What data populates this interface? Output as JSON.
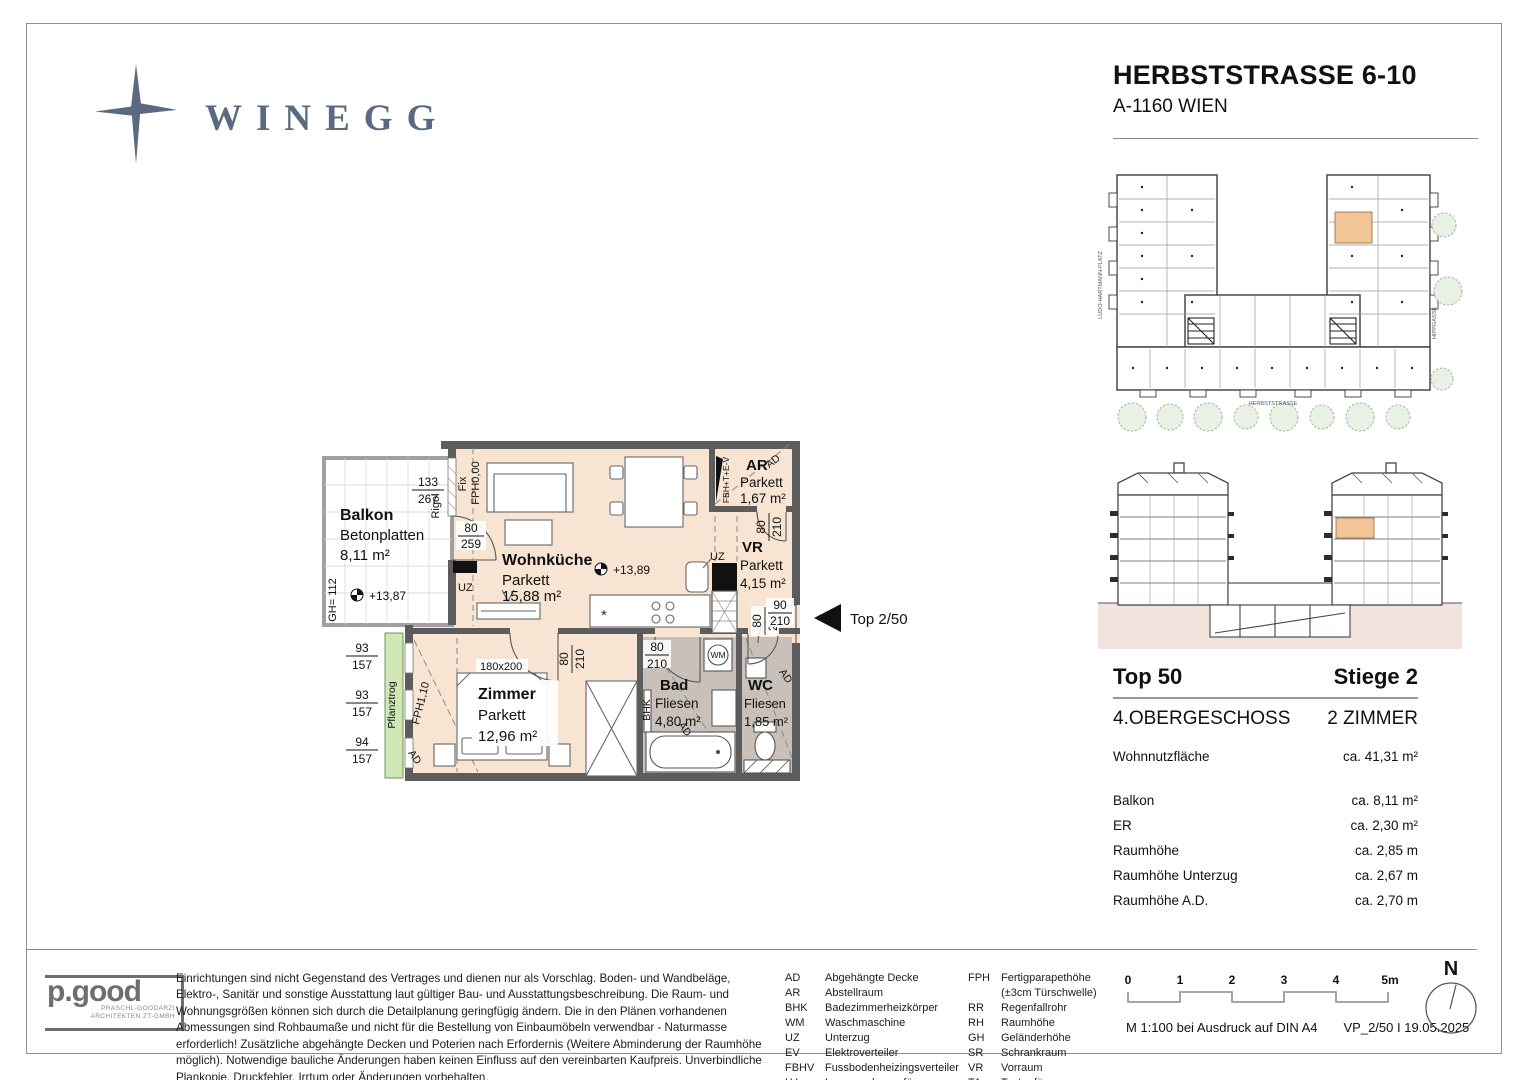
{
  "header": {
    "brand": "WINEGG",
    "project_title": "HERBSTSTRASSE 6-10",
    "project_location": "A-1160 WIEN"
  },
  "site_plan": {
    "street_left": "LUDO-HARTMANN-PLATZ",
    "street_bottom": "HERBSTSTRASSE",
    "street_right": "HIPPGASSE"
  },
  "floor_plan": {
    "entrance_label": "Top 2/50",
    "rooms": [
      {
        "name": "Balkon",
        "surface": "Betonplatten",
        "area": "8,11 m²"
      },
      {
        "name": "Wohnküche",
        "surface": "Parkett",
        "area": "15,88 m²"
      },
      {
        "name": "AR",
        "surface": "Parkett",
        "area": "1,67 m²"
      },
      {
        "name": "VR",
        "surface": "Parkett",
        "area": "4,15 m²"
      },
      {
        "name": "Zimmer",
        "surface": "Parkett",
        "area": "12,96 m²"
      },
      {
        "name": "Bad",
        "surface": "Fliesen",
        "area": "4,80 m²"
      },
      {
        "name": "WC",
        "surface": "Fliesen",
        "area": "1,85 m²"
      }
    ],
    "levels": {
      "balcony": "+13,87",
      "living": "+13,89"
    },
    "dims": {
      "balcony_door": {
        "num": "133",
        "den": "267"
      },
      "fix_window": {
        "num": "80",
        "den": "259"
      },
      "door": {
        "num": "80",
        "den": "210"
      },
      "entry_door": {
        "num": "90",
        "den": "210"
      },
      "windows_left": [
        {
          "num": "93",
          "den": "157"
        },
        {
          "num": "93",
          "den": "157"
        },
        {
          "num": "94",
          "den": "157"
        }
      ],
      "bed": "180x200",
      "railing_height": "GH= 112"
    },
    "annotations": {
      "fix": "Fix",
      "fph_zero": "FPH0,00",
      "rigol": "Rigol",
      "uz": "UZ",
      "pflanztrog": "Pflanztrog",
      "fph_110": "FPH1,10",
      "ad": "AD",
      "bhk": "BHK",
      "wm": "WM",
      "electro_panel": "FBH+T+E-V"
    }
  },
  "unit_info": {
    "unit": "Top 50",
    "staircase": "Stiege 2",
    "floor": "4.OBERGESCHOSS",
    "rooms": "2 ZIMMER",
    "main_row": {
      "label": "Wohnnutzfläche",
      "value": "ca. 41,31 m²"
    },
    "rows": [
      {
        "label": "Balkon",
        "value": "ca.  8,11 m²"
      },
      {
        "label": "ER",
        "value": "ca.  2,30 m²"
      },
      {
        "label": "Raumhöhe",
        "value": "ca.  2,85 m"
      },
      {
        "label": "Raumhöhe Unterzug",
        "value": "ca.  2,67 m"
      },
      {
        "label": "Raumhöhe A.D.",
        "value": "ca.  2,70 m"
      }
    ]
  },
  "footer": {
    "architect": {
      "name": "p.good",
      "sub1": "PRASCHL-GOODARZI",
      "sub2": "ARCHITEKTEN ZT-GMBH"
    },
    "disclaimer": "Einrichtungen sind nicht Gegenstand des Vertrages und dienen nur als Vorschlag. Boden- und Wandbeläge, Elektro-, Sanitär und sonstige Ausstattung laut gültiger Bau- und Ausstattungsbeschreibung. Die Raum- und Wohnungsgrößen können sich durch die Detailplanung geringfügig ändern. Die in den Plänen vorhandenen Abmessungen sind Rohbaumaße und nicht für die Bestellung von Einbaumöbeln verwendbar - Naturmasse erforderlich! Zusätzliche abgehängte Decken und Poterien nach Erfordernis (Weitere Abminderung der Raumhöhe möglich). Notwendige bauliche Änderungen haben keinen Einfluss auf den vereinbarten Kaufpreis. Unverbindliche Plankopie. Druckfehler, Irrtum oder Änderungen vorbehalten.",
    "legend_col1": [
      {
        "abbr": "AD",
        "text": "Abgehängte Decke"
      },
      {
        "abbr": "AR",
        "text": "Abstellraum"
      },
      {
        "abbr": "BHK",
        "text": "Badezimmerheizkörper"
      },
      {
        "abbr": "WM",
        "text": "Waschmaschine"
      },
      {
        "abbr": "UZ",
        "text": "Unterzug"
      },
      {
        "abbr": "EV",
        "text": "Elektroverteiler"
      },
      {
        "abbr": "FBHV",
        "text": "Fussbodenheizingsverteiler"
      },
      {
        "abbr": "LV",
        "text": "Leerverrohrung für autom.Türöffner"
      }
    ],
    "legend_col2": [
      {
        "abbr": "FPH",
        "text": "Fertigparapethöhe",
        "text2": "(±3cm Türschwelle)"
      },
      {
        "abbr": "RR",
        "text": "Regenfallrohr"
      },
      {
        "abbr": "RH",
        "text": "Raumhöhe"
      },
      {
        "abbr": "GH",
        "text": "Geländerhöhe"
      },
      {
        "abbr": "SR",
        "text": "Schrankraum"
      },
      {
        "abbr": "VR",
        "text": "Vorraum"
      },
      {
        "abbr": "TA",
        "text": "Taster für autom.Türöffner"
      }
    ],
    "scale_ticks": [
      "0",
      "1",
      "2",
      "3",
      "4",
      "5m"
    ],
    "print_note": "M 1:100 bei Ausdruck auf DIN A4",
    "plan_version": "VP_2/50 I 19.05.2025",
    "north_label": "N"
  },
  "colors": {
    "brand_slate": "#5a6a80",
    "wall": "#5c5c5c",
    "parquet_floor": "#f8e4d2",
    "tile_floor": "#c9c1b9",
    "unit_highlight": "#f2c496",
    "planter_green": "#cfe6b5",
    "tree_green": "#e9f1e5",
    "section_ground": "#f2e4dc"
  }
}
